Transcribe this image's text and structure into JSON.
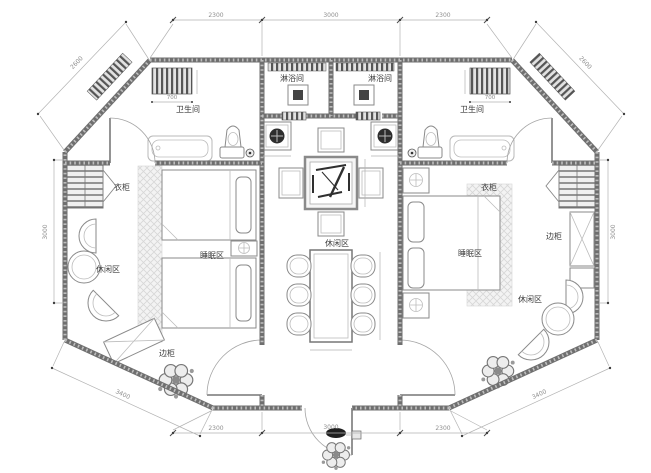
{
  "labels": {
    "bathroom_left": "卫生间",
    "bathroom_right": "卫生间",
    "shower_left": "淋浴间",
    "shower_right": "淋浴间",
    "wardrobe_left": "衣柜",
    "wardrobe_right": "衣柜",
    "sleeping_left": "睡眠区",
    "sleeping_right": "睡眠区",
    "lounge_center": "休闲区",
    "lounge_left": "休闲区",
    "lounge_right": "休闲区",
    "sideboard_left": "边柜",
    "sideboard_right": "边柜"
  },
  "dimensions": {
    "top_left": "2300",
    "top_center": "3000",
    "top_right": "2300",
    "bottom_left": "2300",
    "bottom_center": "3000",
    "bottom_right": "2300",
    "side_left": "3000",
    "side_right": "3000",
    "diag_top_left": "2600",
    "diag_top_right": "2600",
    "diag_bottom_left": "3400",
    "diag_bottom_right": "3400",
    "radiator_left": "700",
    "radiator_right": "700"
  },
  "colors": {
    "wall": "#6f6f6f",
    "line": "#b3b3b3",
    "dim_text": "#8f8f8f",
    "label_text": "#3c3c3c",
    "carpet": "#f3f3f3"
  }
}
